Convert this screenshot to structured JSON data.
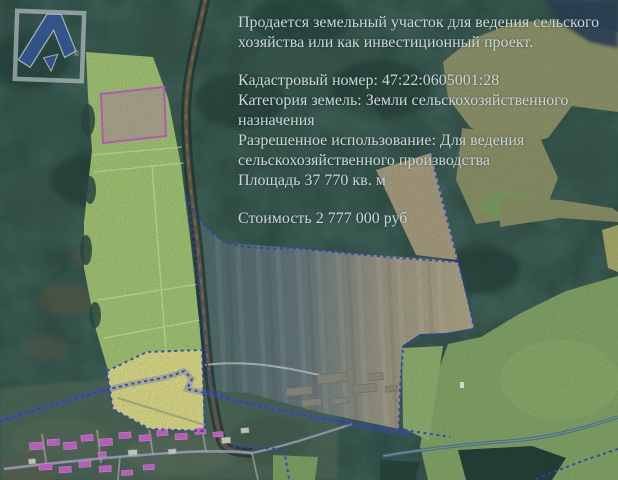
{
  "listing": {
    "intro": "Продается земельный участок для ведения сельского хозяйства или как инвестиционный проект.",
    "details": [
      "Кадастровый номер: 47:22:0605001:28",
      "Категория земель: Земли сельскохозяйственного назначения",
      "Разрешенное использование: Для ведения сельскохозяйственного производства",
      "Площадь 37 770 кв. м"
    ],
    "price": "Стоимость 2 777 000 руб"
  },
  "logo": {
    "symbol": "stylized-A-in-square",
    "registered_mark": "®"
  },
  "map": {
    "style": "satellite-cadastral",
    "parcel_outline_color": "#c45cc4",
    "cadastral_boundary_color": "#2e40d6",
    "overlay_text_color": "#ccd5d9"
  }
}
